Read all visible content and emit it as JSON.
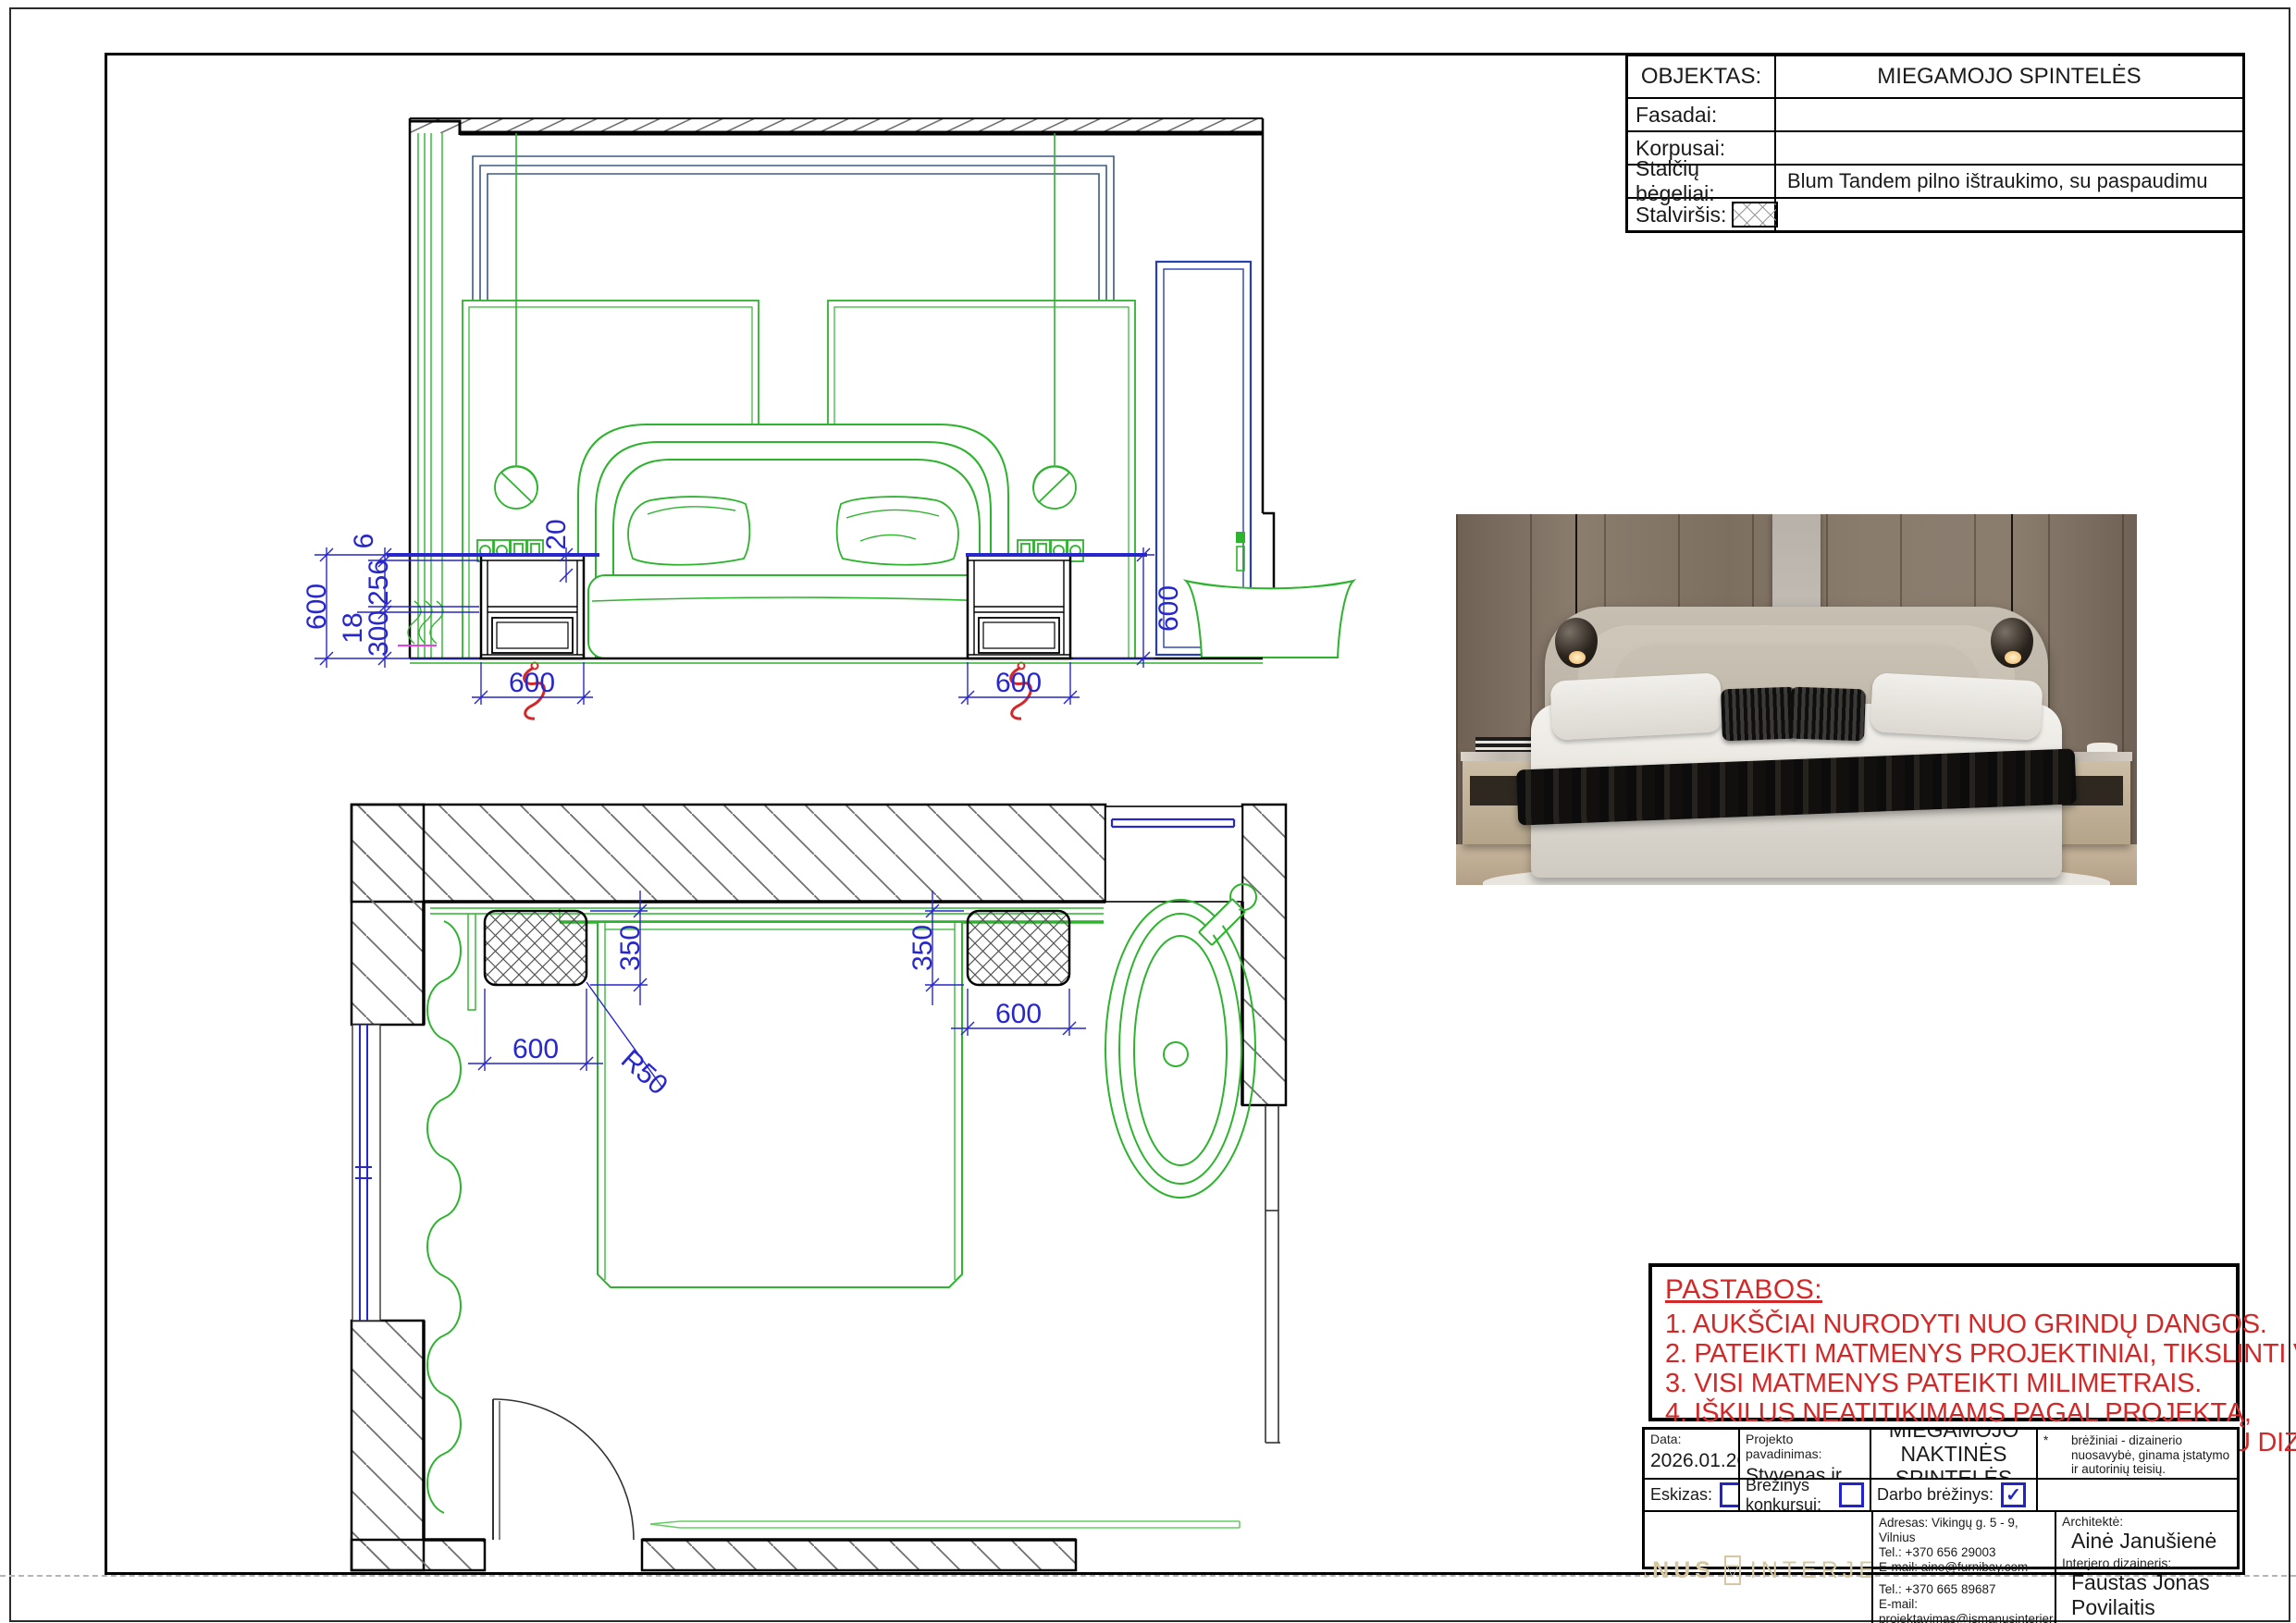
{
  "sheet": {
    "spec_table": {
      "rows": [
        {
          "label": "OBJEKTAS:",
          "value": "MIEGAMOJO SPINTELĖS"
        },
        {
          "label": "Fasadai:",
          "value": ""
        },
        {
          "label": "Korpusai:",
          "value": ""
        },
        {
          "label": "Stalčių bėgeliai:",
          "value": "Blum Tandem pilno ištraukimo, su paspaudimu"
        },
        {
          "label": "Stalviršis:",
          "value": ""
        }
      ]
    },
    "notes": {
      "title": "PASTABOS:",
      "items": [
        "1. AUKŠČIAI NURODYTI NUO GRINDŲ DANGOS.",
        "2. PATEIKTI MATMENYS PROJEKTINIAI, TIKSLINTI VIETOJE.",
        "3. VISI MATMENYS PATEIKTI MILIMETRAIS.",
        "4. IŠKILUS NEATITIKIMAMS PAGAL PROJEKTĄ,",
        "    AR DARANT KITUS PAKEITIMUS DERINTI SU DIZAINERIAIS."
      ]
    },
    "title_block": {
      "date_label": "Data:",
      "date_value": "2026.01.26",
      "project_label": "Projekto pavadinimas:",
      "project_value": "Styvenas ir Silvestras",
      "drawing_title_line1": "MIEGAMOJO",
      "drawing_title_line2": "NAKTINĖS SPINTELĖS",
      "sketch_label": "Eskizas:",
      "contest_label": "Brėžinys konkursui:",
      "working_label": "Darbo brėžinys:",
      "check_glyph": "✓",
      "disclaimer": [
        {
          "mark": "*",
          "text": "brėžiniai - dizainerio nuosavybė, ginama įstatymo ir autorinių teisių."
        },
        {
          "mark": "**",
          "text": "statyti pagal aprobuotus darbo brėžinius."
        },
        {
          "mark": "***",
          "text": "statybininkas atsakingas už matmenų atitikimą."
        },
        {
          "mark": "****",
          "text": "apie neatitikimus nedelsiant pranešti projekto vadovui."
        }
      ],
      "logo_part1": "IŠMANUS",
      "logo_glyph": "▽",
      "logo_part2": "INTERJERAS",
      "address_line1": "Adresas: Vikingų g. 5 - 9, Vilnius",
      "address_line2": "Tel.: +370 656 29003",
      "address_line3": "E-mail: aine@furnibay.com",
      "address_line4": "Tel.: +370 665 89687",
      "address_line5": "E-mail: projektavimas@ismanusinterjeras.lt",
      "architect_label": "Architektė:",
      "architect_name": "Ainė Janušienė",
      "designer_label": "Interjero dizaineris:",
      "designer_name": "Faustas Jonas Povilaitis"
    },
    "dims": {
      "elev": {
        "v600_left": "600",
        "d6": "6",
        "d256": "256",
        "d18": "18",
        "d300": "300",
        "d20": "20",
        "b600_left": "600",
        "b600_right": "600",
        "v600_right": "600"
      },
      "plan": {
        "l350": "350",
        "l600": "600",
        "r50": "R50",
        "r350": "350",
        "r600": "600"
      }
    },
    "colors": {
      "cad_green": "#2db32d",
      "dim_blue": "#2727cc",
      "cove_navy": "#3c5a82",
      "note_red": "#d42828",
      "logo_gold": "#d6c7a0"
    }
  }
}
